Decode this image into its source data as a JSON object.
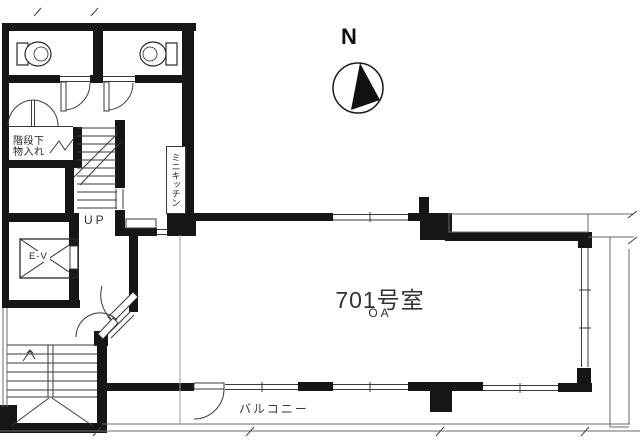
{
  "compass": {
    "label": "N"
  },
  "unit": {
    "room_number": "701号室",
    "floor_type": "OA"
  },
  "labels": {
    "balcony": "バルコニー",
    "stairs_up": "UP",
    "elevator": "E-V",
    "mini_kitchen": "ミニキッチン",
    "under_stair_storage": [
      "階段下",
      "物入れ"
    ]
  },
  "colors": {
    "wall": "#161616",
    "line": "#3a3a3a",
    "faint": "#999999",
    "background": "#ffffff",
    "text": "#2b2b2b"
  }
}
